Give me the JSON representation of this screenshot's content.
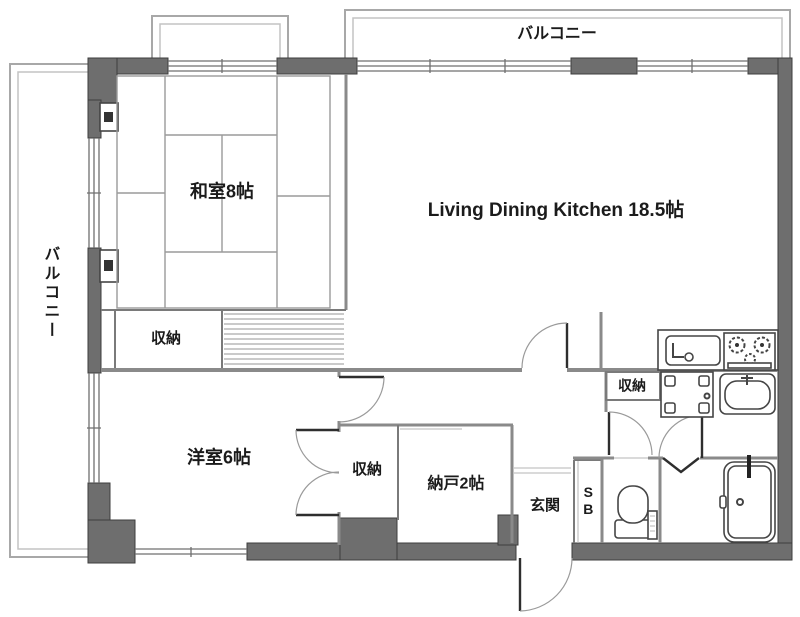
{
  "plan": {
    "labels": {
      "balcony_top": "バルコニー",
      "balcony_left": "バルコニー",
      "washitsu": "和室8帖",
      "ldk": "Living Dining Kitchen 18.5帖",
      "youshitsu": "洋室6帖",
      "nando": "納戸2帖",
      "genkan": "玄関",
      "shoebox": "SB",
      "closet_washitsu": "収納",
      "closet_youshitsu": "収納",
      "closet_washroom": "収納"
    },
    "fixtures": [
      "kitchen-sink",
      "gas-stove",
      "washing-machine-pan",
      "vanity-basin",
      "toilet",
      "bathtub",
      "folding-door",
      "entrance-door",
      "shutter-box",
      "shutter-box"
    ],
    "colors": {
      "wall": "#6e6e6e",
      "line": "#8f8f8f",
      "fixture": "#454545",
      "text": "#1b1b1b",
      "background": "#ffffff"
    }
  }
}
